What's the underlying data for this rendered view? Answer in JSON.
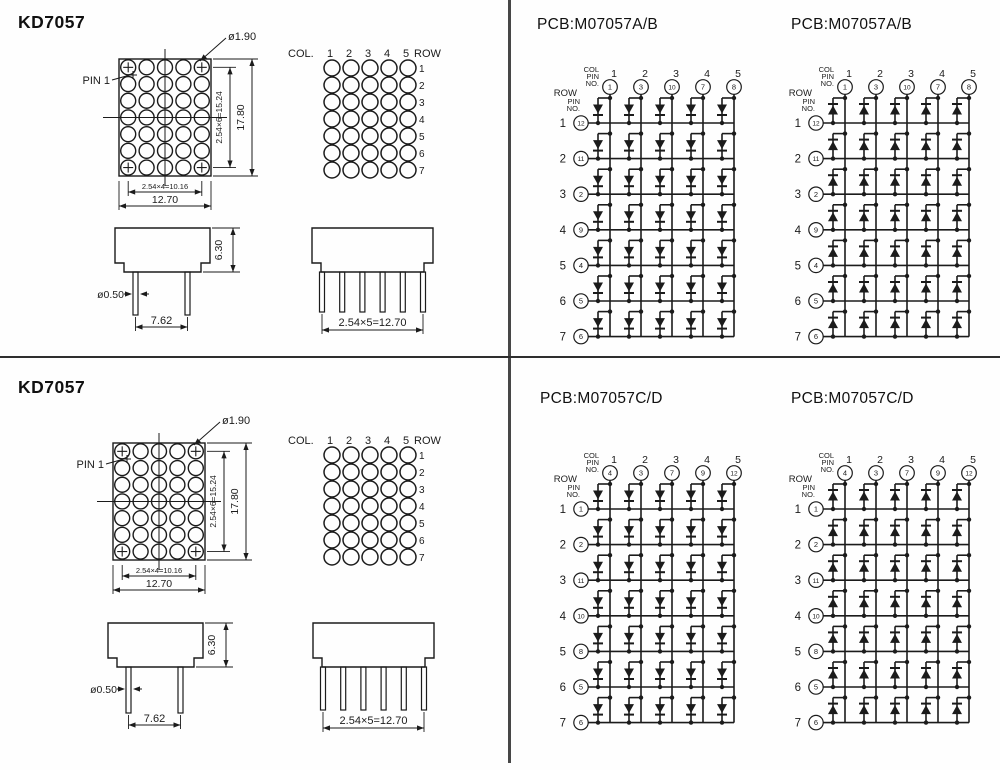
{
  "page": {
    "background": "#fefefe",
    "ink_color": "#1b1b1b"
  },
  "left_panels": [
    {
      "title": "KD7057",
      "front_view": {
        "pin1_label": "PIN 1",
        "led_diameter": "ø1.90",
        "dim_h_inner": "2.54×4=10.16",
        "dim_h_outer": "12.70",
        "dim_v_inner": "2.54×6=15.24",
        "dim_v_outer": "17.80"
      },
      "matrix_view": {
        "col_label": "COL.",
        "row_label": "ROW",
        "col_numbers": [
          "1",
          "2",
          "3",
          "4",
          "5"
        ],
        "row_numbers": [
          "1",
          "2",
          "3",
          "4",
          "5",
          "6",
          "7"
        ]
      },
      "side_view": {
        "dim_height": "6.30",
        "dim_pin_diameter": "ø0.50",
        "dim_pin_spacing": "7.62"
      },
      "bottom_view": {
        "dim_pin_pitch": "2.54×5=12.70"
      }
    },
    {
      "title": "KD7057",
      "front_view": {
        "pin1_label": "PIN 1",
        "led_diameter": "ø1.90",
        "dim_h_inner": "2.54×4=10.16",
        "dim_h_outer": "12.70",
        "dim_v_inner": "2.54×6=15.24",
        "dim_v_outer": "17.80"
      },
      "matrix_view": {
        "col_label": "COL.",
        "row_label": "ROW",
        "col_numbers": [
          "1",
          "2",
          "3",
          "4",
          "5"
        ],
        "row_numbers": [
          "1",
          "2",
          "3",
          "4",
          "5",
          "6",
          "7"
        ]
      },
      "side_view": {
        "dim_height": "6.30",
        "dim_pin_diameter": "ø0.50",
        "dim_pin_spacing": "7.62"
      },
      "bottom_view": {
        "dim_pin_pitch": "2.54×5=12.70"
      }
    }
  ],
  "schematics": [
    {
      "title": "PCB:M07057A/B",
      "diode_direction": "down",
      "labels": {
        "col": "COL",
        "pin": "PIN",
        "no": "NO.",
        "row": "ROW"
      },
      "col_numbers": [
        "1",
        "2",
        "3",
        "4",
        "5"
      ],
      "row_numbers": [
        "1",
        "2",
        "3",
        "4",
        "5",
        "6",
        "7"
      ],
      "col_pins": [
        "1",
        "3",
        "10",
        "7",
        "8"
      ],
      "row_pins": [
        "12",
        "11",
        "2",
        "9",
        "4",
        "5",
        "6"
      ]
    },
    {
      "title": "PCB:M07057A/B",
      "diode_direction": "up",
      "labels": {
        "col": "COL",
        "pin": "PIN",
        "no": "NO.",
        "row": "ROW"
      },
      "col_numbers": [
        "1",
        "2",
        "3",
        "4",
        "5"
      ],
      "row_numbers": [
        "1",
        "2",
        "3",
        "4",
        "5",
        "6",
        "7"
      ],
      "col_pins": [
        "1",
        "3",
        "10",
        "7",
        "8"
      ],
      "row_pins": [
        "12",
        "11",
        "2",
        "9",
        "4",
        "5",
        "6"
      ]
    },
    {
      "title": "PCB:M07057C/D",
      "diode_direction": "down",
      "labels": {
        "col": "COL",
        "pin": "PIN",
        "no": "NO.",
        "row": "ROW"
      },
      "col_numbers": [
        "1",
        "2",
        "3",
        "4",
        "5"
      ],
      "row_numbers": [
        "1",
        "2",
        "3",
        "4",
        "5",
        "6",
        "7"
      ],
      "col_pins": [
        "4",
        "3",
        "7",
        "9",
        "12"
      ],
      "row_pins": [
        "1",
        "2",
        "11",
        "10",
        "8",
        "5",
        "6"
      ]
    },
    {
      "title": "PCB:M07057C/D",
      "diode_direction": "up",
      "labels": {
        "col": "COL",
        "pin": "PIN",
        "no": "NO.",
        "row": "ROW"
      },
      "col_numbers": [
        "1",
        "2",
        "3",
        "4",
        "5"
      ],
      "row_numbers": [
        "1",
        "2",
        "3",
        "4",
        "5",
        "6",
        "7"
      ],
      "col_pins": [
        "4",
        "3",
        "7",
        "9",
        "12"
      ],
      "row_pins": [
        "1",
        "2",
        "11",
        "10",
        "8",
        "5",
        "6"
      ]
    }
  ]
}
